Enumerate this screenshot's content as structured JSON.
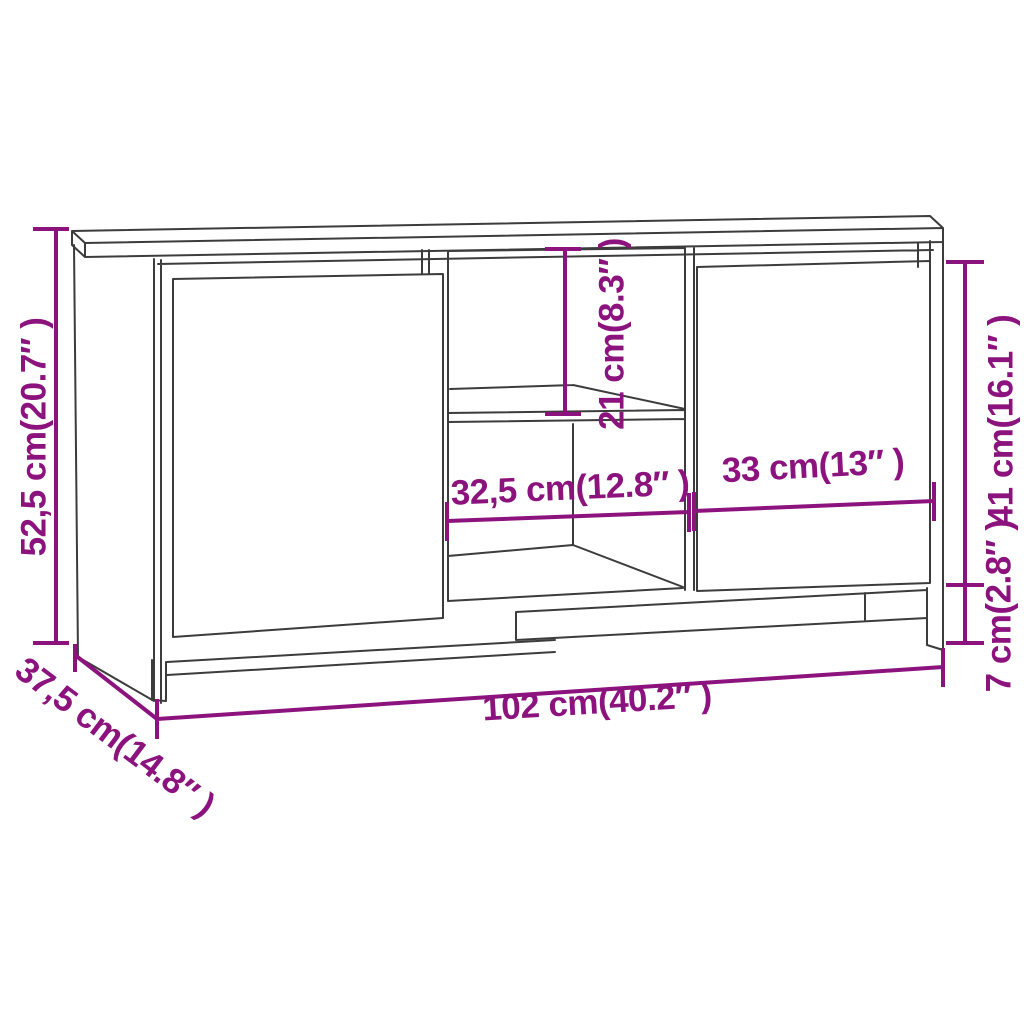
{
  "diagram": {
    "title": "TV cabinet dimension diagram",
    "style": "3d-perspective-line-drawing"
  },
  "colors": {
    "dimension": "#8C137E",
    "line_art": "#3C3C3C",
    "background": "#FFFFFF"
  },
  "dimensions": {
    "overall_height": {
      "label": "52,5 cm(20.7″ )",
      "value_cm": "52,5",
      "value_inch": "20.7",
      "placement": "left-vertical"
    },
    "overall_depth": {
      "label": "37,5 cm(14.8″ )",
      "value_cm": "37,5",
      "value_inch": "14.8",
      "placement": "bottom-left-diagonal"
    },
    "overall_width": {
      "label": "102 cm(40.2″ )",
      "value_cm": "102",
      "value_inch": "40.2",
      "placement": "bottom-horizontal"
    },
    "middle_opening_width": {
      "label": "32,5 cm(12.8″ )",
      "value_cm": "32,5",
      "value_inch": "12.8",
      "placement": "middle-horizontal-left"
    },
    "right_door_width": {
      "label": "33 cm(13″ )",
      "value_cm": "33",
      "value_inch": "13",
      "placement": "middle-horizontal-right"
    },
    "top_compartment_height": {
      "label": "21 cm(8.3″ )",
      "value_cm": "21",
      "value_inch": "8.3",
      "placement": "center-vertical"
    },
    "door_height": {
      "label": "41 cm(16.1″ )",
      "value_cm": "41",
      "value_inch": "16.1",
      "placement": "right-vertical-upper"
    },
    "leg_height": {
      "label": "7 cm(2.8″ )",
      "value_cm": "7",
      "value_inch": "2.8",
      "placement": "right-vertical-lower"
    }
  }
}
